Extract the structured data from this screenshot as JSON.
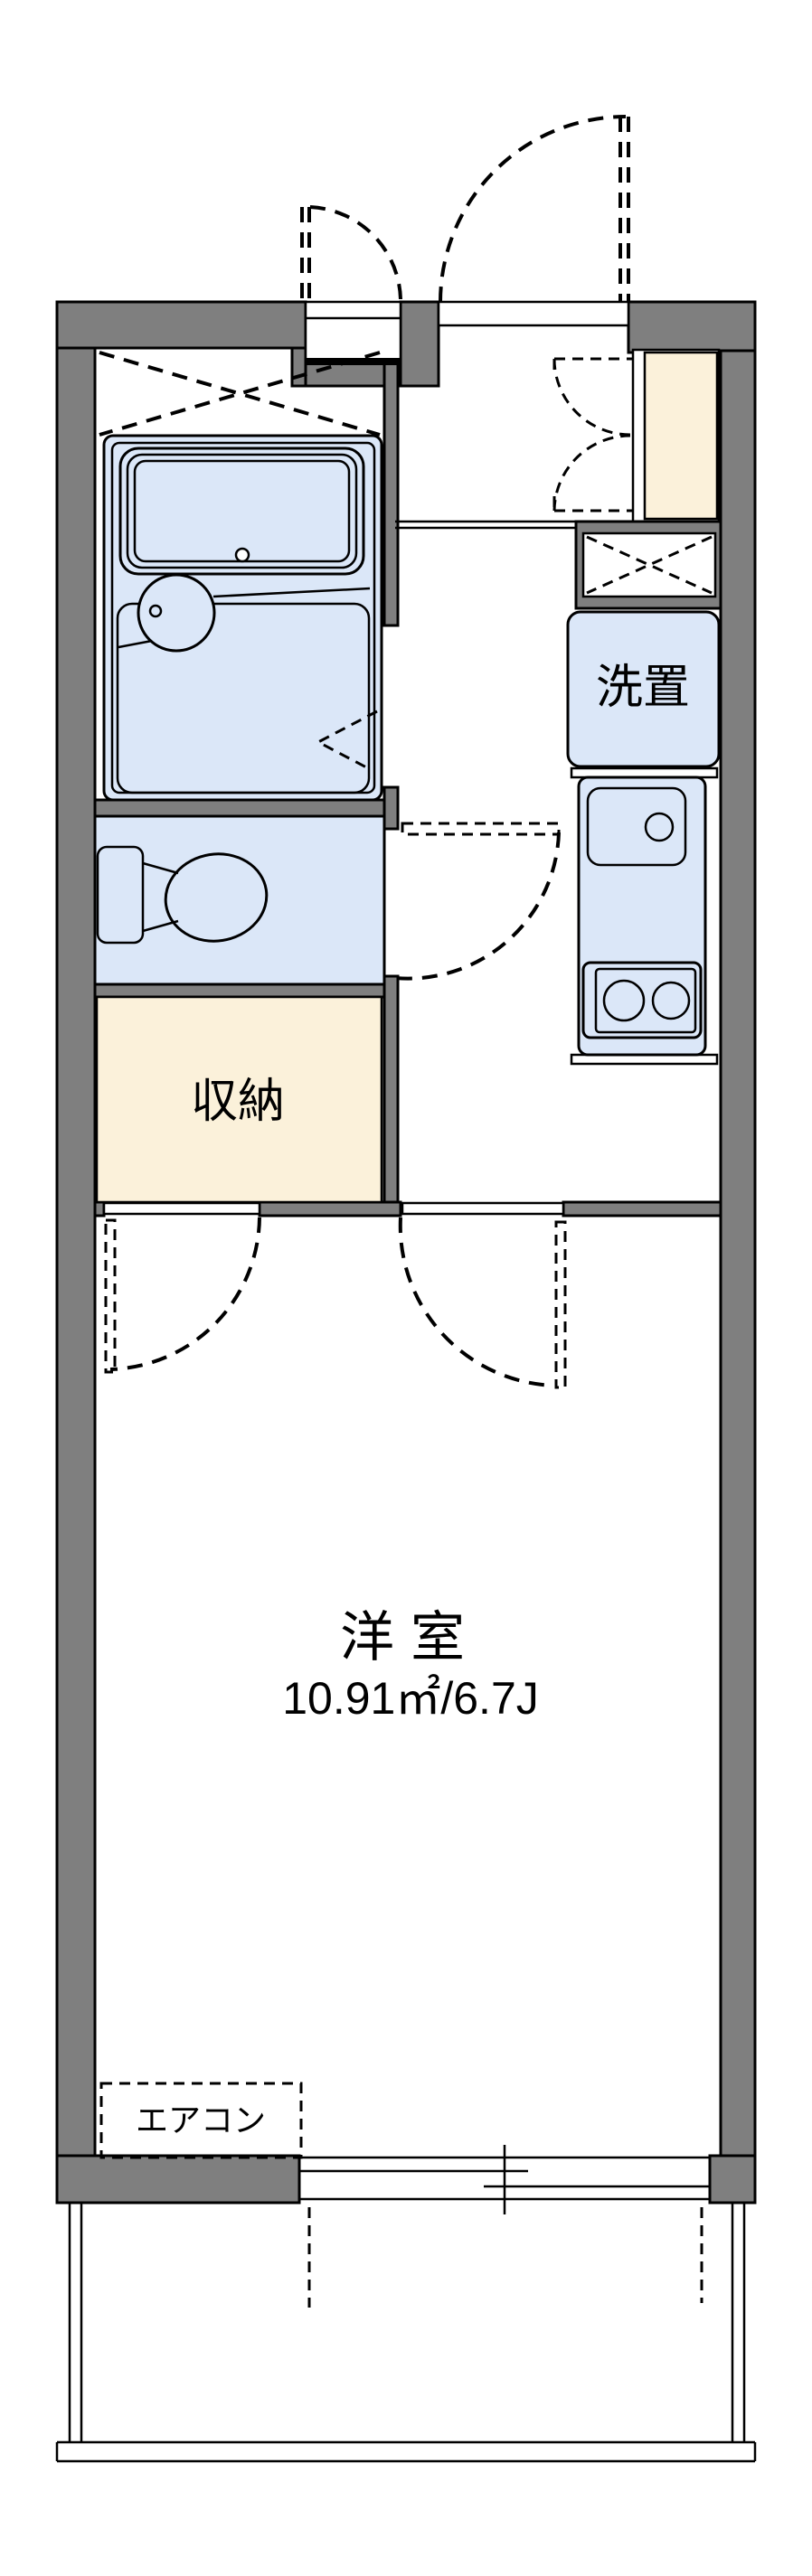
{
  "colors": {
    "wall": "#7f7f7f",
    "line": "#000000",
    "room_fill": "#dbe7f8",
    "storage_fill": "#fbf1da",
    "bg": "#ffffff"
  },
  "rooms": {
    "western_room": {
      "label": "洋室",
      "area": "10.91㎡/6.7J"
    },
    "storage": {
      "label": "収納"
    },
    "laundry": {
      "label": "洗置"
    },
    "aircon": {
      "label": "エアコン"
    }
  }
}
